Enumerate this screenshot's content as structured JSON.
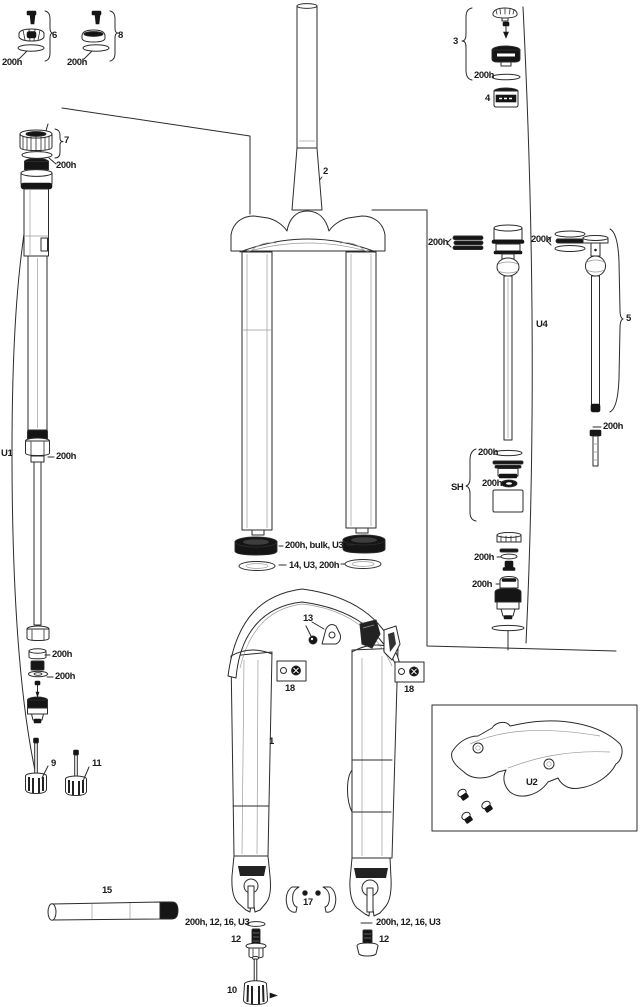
{
  "diagram": {
    "colors": {
      "background": "#ffffff",
      "line": "#2b2b2b",
      "dark_fill": "#151515"
    },
    "callouts": [
      {
        "name": "part-6-label",
        "text": "6"
      },
      {
        "name": "group6-service-interval",
        "text": "200h"
      },
      {
        "name": "part-8-label",
        "text": "8"
      },
      {
        "name": "group8-service-interval",
        "text": "200h"
      },
      {
        "name": "part-3-label",
        "text": "3"
      },
      {
        "name": "group3-service-interval",
        "text": "200h"
      },
      {
        "name": "part-4-label",
        "text": "4"
      },
      {
        "name": "part-7-label",
        "text": "7"
      },
      {
        "name": "group7-service-interval",
        "text": "200h"
      },
      {
        "name": "part-2-label",
        "text": "2"
      },
      {
        "name": "assembly-u1-label",
        "text": "U1"
      },
      {
        "name": "u1-foot-service-interval",
        "text": "200h"
      },
      {
        "name": "left-stack-service-interval-top",
        "text": "200h"
      },
      {
        "name": "left-stack-service-interval-bottom",
        "text": "200h"
      },
      {
        "name": "part-9-label",
        "text": "9"
      },
      {
        "name": "part-11-label",
        "text": "11"
      },
      {
        "name": "dust-seal-callout",
        "text": "200h, bulk, U3"
      },
      {
        "name": "foam-ring-callout",
        "text": "14, U3, 200h"
      },
      {
        "name": "part-13-label",
        "text": "13"
      },
      {
        "name": "part-18-left-label",
        "text": "18"
      },
      {
        "name": "part-18-right-label",
        "text": "18"
      },
      {
        "name": "part-1-label",
        "text": "1"
      },
      {
        "name": "u4-rings-service-interval",
        "text": "200h"
      },
      {
        "name": "part5-rings-service-interval",
        "text": "200h"
      },
      {
        "name": "assembly-u4-label",
        "text": "U4"
      },
      {
        "name": "part-5-label",
        "text": "5"
      },
      {
        "name": "part5-foot-service-interval",
        "text": "200h"
      },
      {
        "name": "assembly-sh-label",
        "text": "SH"
      },
      {
        "name": "sh-service-interval-top",
        "text": "200h"
      },
      {
        "name": "sh-service-interval-mid",
        "text": "200h"
      },
      {
        "name": "right-stack-service-interval-rings",
        "text": "200h"
      },
      {
        "name": "right-stack-service-interval-cap",
        "text": "200h"
      },
      {
        "name": "assembly-u2-label",
        "text": "U2"
      },
      {
        "name": "part-15-label",
        "text": "15"
      },
      {
        "name": "axle-bolt-callout-left",
        "text": "200h, 12, 16, U3"
      },
      {
        "name": "part-12-left-label",
        "text": "12"
      },
      {
        "name": "part-17-label",
        "text": "17"
      },
      {
        "name": "axle-bolt-callout-right",
        "text": "200h, 12, 16, U3"
      },
      {
        "name": "part-12-right-label",
        "text": "12"
      },
      {
        "name": "part-10-label",
        "text": "10"
      }
    ]
  }
}
